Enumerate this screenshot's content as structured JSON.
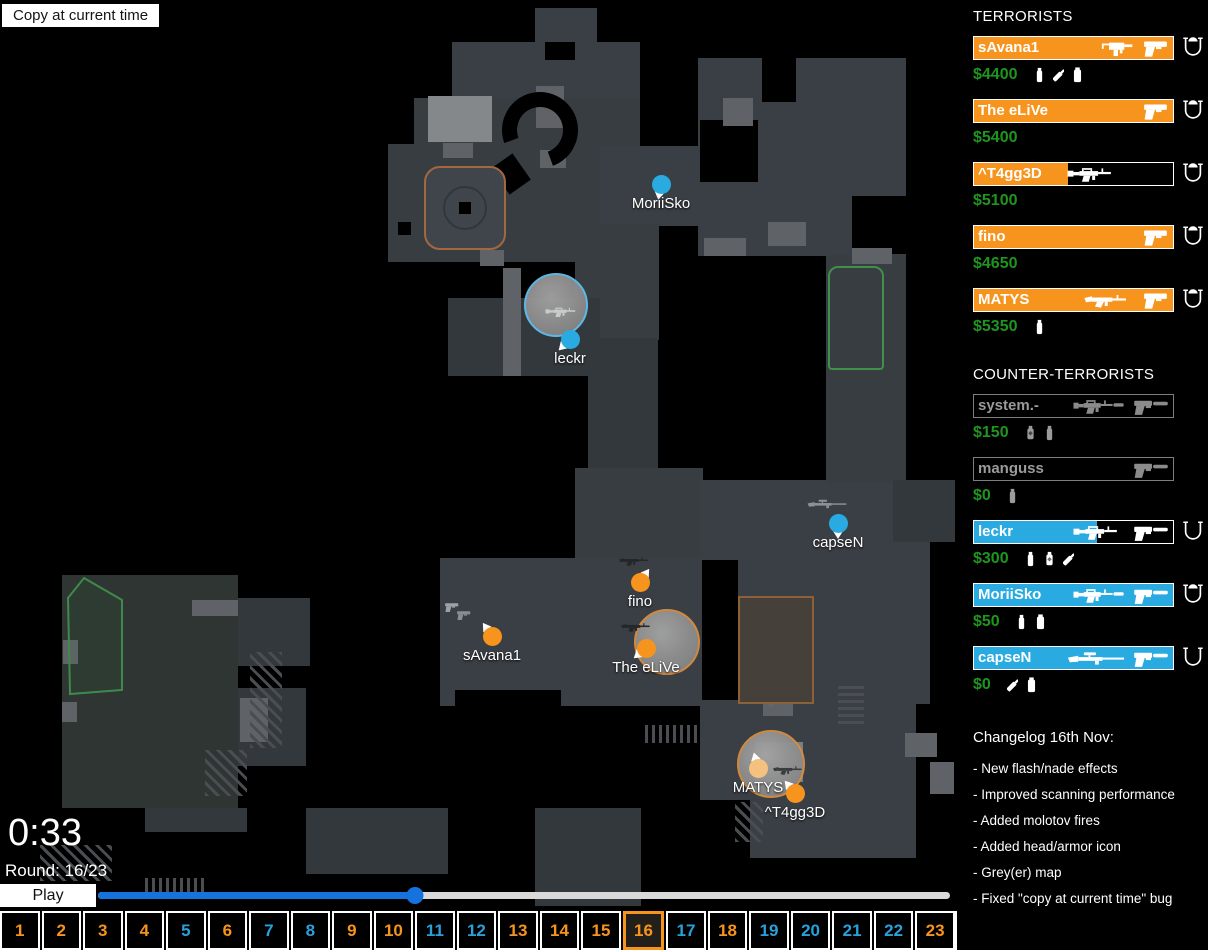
{
  "header": {
    "copy_button_label": "Copy at current time"
  },
  "hud": {
    "clock": "0:33",
    "round_label": "Round: 16/23",
    "play_label": "Play",
    "slider_percent": 37.2
  },
  "colors": {
    "t": "#F7941D",
    "ct": "#29ABE2",
    "t_faded": "#F4C27E",
    "money_green": "#1E961E",
    "slider_blue": "#1673DD",
    "smoke_ring_orange": "#D98E3F",
    "smoke_ring_blue": "#5FC0EE"
  },
  "teams": {
    "terrorists": {
      "title": "TERRORISTS",
      "players": [
        {
          "name": "sAvana1",
          "money": "$4400",
          "health_pct": 100,
          "alive": true,
          "weapons": [
            "smg-mac10",
            "pistol-glock"
          ],
          "grenades": [
            "flashbang",
            "molotov",
            "smoke"
          ],
          "armor": "helmet"
        },
        {
          "name": "The eLiVe",
          "money": "$5400",
          "health_pct": 100,
          "alive": true,
          "weapons": [
            "pistol-glock"
          ],
          "grenades": [],
          "armor": "helmet"
        },
        {
          "name": "^T4gg3D",
          "money": "$5100",
          "health_pct": 47,
          "alive": true,
          "weapons": [
            "rifle-m4"
          ],
          "grenades": [],
          "armor": "helmet"
        },
        {
          "name": "fino",
          "money": "$4650",
          "health_pct": 100,
          "alive": true,
          "weapons": [
            "pistol-glock"
          ],
          "grenades": [],
          "armor": "helmet"
        },
        {
          "name": "MATYS",
          "money": "$5350",
          "health_pct": 100,
          "alive": true,
          "weapons": [
            "rifle-ak47",
            "pistol-glock"
          ],
          "grenades": [
            "flashbang"
          ],
          "armor": "helmet"
        }
      ]
    },
    "counter_terrorists": {
      "title": "COUNTER-TERRORISTS",
      "players": [
        {
          "name": "system.-",
          "money": "$150",
          "health_pct": 0,
          "alive": false,
          "weapons": [
            "rifle-m4s",
            "pistol-usp"
          ],
          "grenades": [
            "he",
            "flashbang"
          ],
          "armor": null
        },
        {
          "name": "manguss",
          "money": "$0",
          "health_pct": 0,
          "alive": false,
          "weapons": [
            "pistol-usp"
          ],
          "grenades": [
            "flashbang"
          ],
          "armor": null
        },
        {
          "name": "leckr",
          "money": "$300",
          "health_pct": 62,
          "alive": true,
          "weapons": [
            "rifle-m4",
            "pistol-usp"
          ],
          "grenades": [
            "flashbang",
            "he",
            "molotov"
          ],
          "armor": "kevlar"
        },
        {
          "name": "MoriiSko",
          "money": "$50",
          "health_pct": 100,
          "alive": true,
          "weapons": [
            "rifle-m4s",
            "pistol-usp"
          ],
          "grenades": [
            "flashbang",
            "smoke"
          ],
          "armor": "helmet"
        },
        {
          "name": "capseN",
          "money": "$0",
          "health_pct": 100,
          "alive": true,
          "weapons": [
            "sniper-scout",
            "pistol-usp"
          ],
          "grenades": [
            "molotov",
            "smoke"
          ],
          "armor": "kevlar"
        }
      ]
    }
  },
  "changelog": {
    "title": "Changelog 16th Nov:",
    "items": [
      "- New flash/nade effects",
      "- Improved scanning performance",
      "- Added molotov fires",
      "- Added head/armor icon",
      "- Grey(er) map",
      "- Fixed \"copy at current time\" bug"
    ]
  },
  "timeline": {
    "current_round": 16,
    "rounds": [
      {
        "n": 1,
        "winner": "T"
      },
      {
        "n": 2,
        "winner": "T"
      },
      {
        "n": 3,
        "winner": "T"
      },
      {
        "n": 4,
        "winner": "T"
      },
      {
        "n": 5,
        "winner": "CT"
      },
      {
        "n": 6,
        "winner": "T"
      },
      {
        "n": 7,
        "winner": "CT"
      },
      {
        "n": 8,
        "winner": "CT"
      },
      {
        "n": 9,
        "winner": "T"
      },
      {
        "n": 10,
        "winner": "T"
      },
      {
        "n": 11,
        "winner": "CT"
      },
      {
        "n": 12,
        "winner": "CT"
      },
      {
        "n": 13,
        "winner": "T"
      },
      {
        "n": 14,
        "winner": "T"
      },
      {
        "n": 15,
        "winner": "T"
      },
      {
        "n": 16,
        "winner": "T"
      },
      {
        "n": 17,
        "winner": "CT"
      },
      {
        "n": 18,
        "winner": "T"
      },
      {
        "n": 19,
        "winner": "CT"
      },
      {
        "n": 20,
        "winner": "CT"
      },
      {
        "n": 21,
        "winner": "CT"
      },
      {
        "n": 22,
        "winner": "CT"
      },
      {
        "n": 23,
        "winner": "T"
      }
    ]
  },
  "map": {
    "players": [
      {
        "name": "MoriiSko",
        "team": "CT",
        "x": 661,
        "y": 184,
        "angle": 190,
        "faded": false
      },
      {
        "name": "leckr",
        "team": "CT",
        "x": 570,
        "y": 339,
        "angle": 225,
        "faded": false
      },
      {
        "name": "capseN",
        "team": "CT",
        "x": 838,
        "y": 523,
        "angle": 180,
        "faded": false
      },
      {
        "name": "fino",
        "team": "T",
        "x": 640,
        "y": 582,
        "angle": 35,
        "faded": false
      },
      {
        "name": "The eLiVe",
        "team": "T",
        "x": 646,
        "y": 648,
        "angle": 230,
        "faded": false
      },
      {
        "name": "sAvana1",
        "team": "T",
        "x": 492,
        "y": 636,
        "angle": 325,
        "faded": false
      },
      {
        "name": "MATYS",
        "team": "T",
        "x": 758,
        "y": 768,
        "angle": 345,
        "faded": true
      },
      {
        "name": "^T4gg3D",
        "team": "T",
        "x": 795,
        "y": 793,
        "angle": 320,
        "faded": false
      }
    ],
    "smokes": [
      {
        "x": 556,
        "y": 305,
        "r": 30,
        "ring": "blue"
      },
      {
        "x": 667,
        "y": 642,
        "r": 31,
        "ring": "orange"
      },
      {
        "x": 771,
        "y": 764,
        "r": 32,
        "ring": "orange"
      }
    ],
    "dropped_weapons": [
      {
        "type": "rifle-m4",
        "x": 563,
        "y": 312,
        "color": "#c9cbcd"
      },
      {
        "type": "rifle-ak47",
        "x": 636,
        "y": 561,
        "color": "#24272a"
      },
      {
        "type": "rifle-ak47",
        "x": 638,
        "y": 627,
        "color": "#24272a"
      },
      {
        "type": "pistol-glock",
        "x": 452,
        "y": 607,
        "color": "#9fa2a5"
      },
      {
        "type": "pistol-glock",
        "x": 464,
        "y": 615,
        "color": "#8a8d90"
      },
      {
        "type": "sniper-scout",
        "x": 827,
        "y": 504,
        "color": "#8f9295"
      },
      {
        "type": "rifle-ak47",
        "x": 790,
        "y": 770,
        "color": "#3a3d40"
      }
    ]
  }
}
